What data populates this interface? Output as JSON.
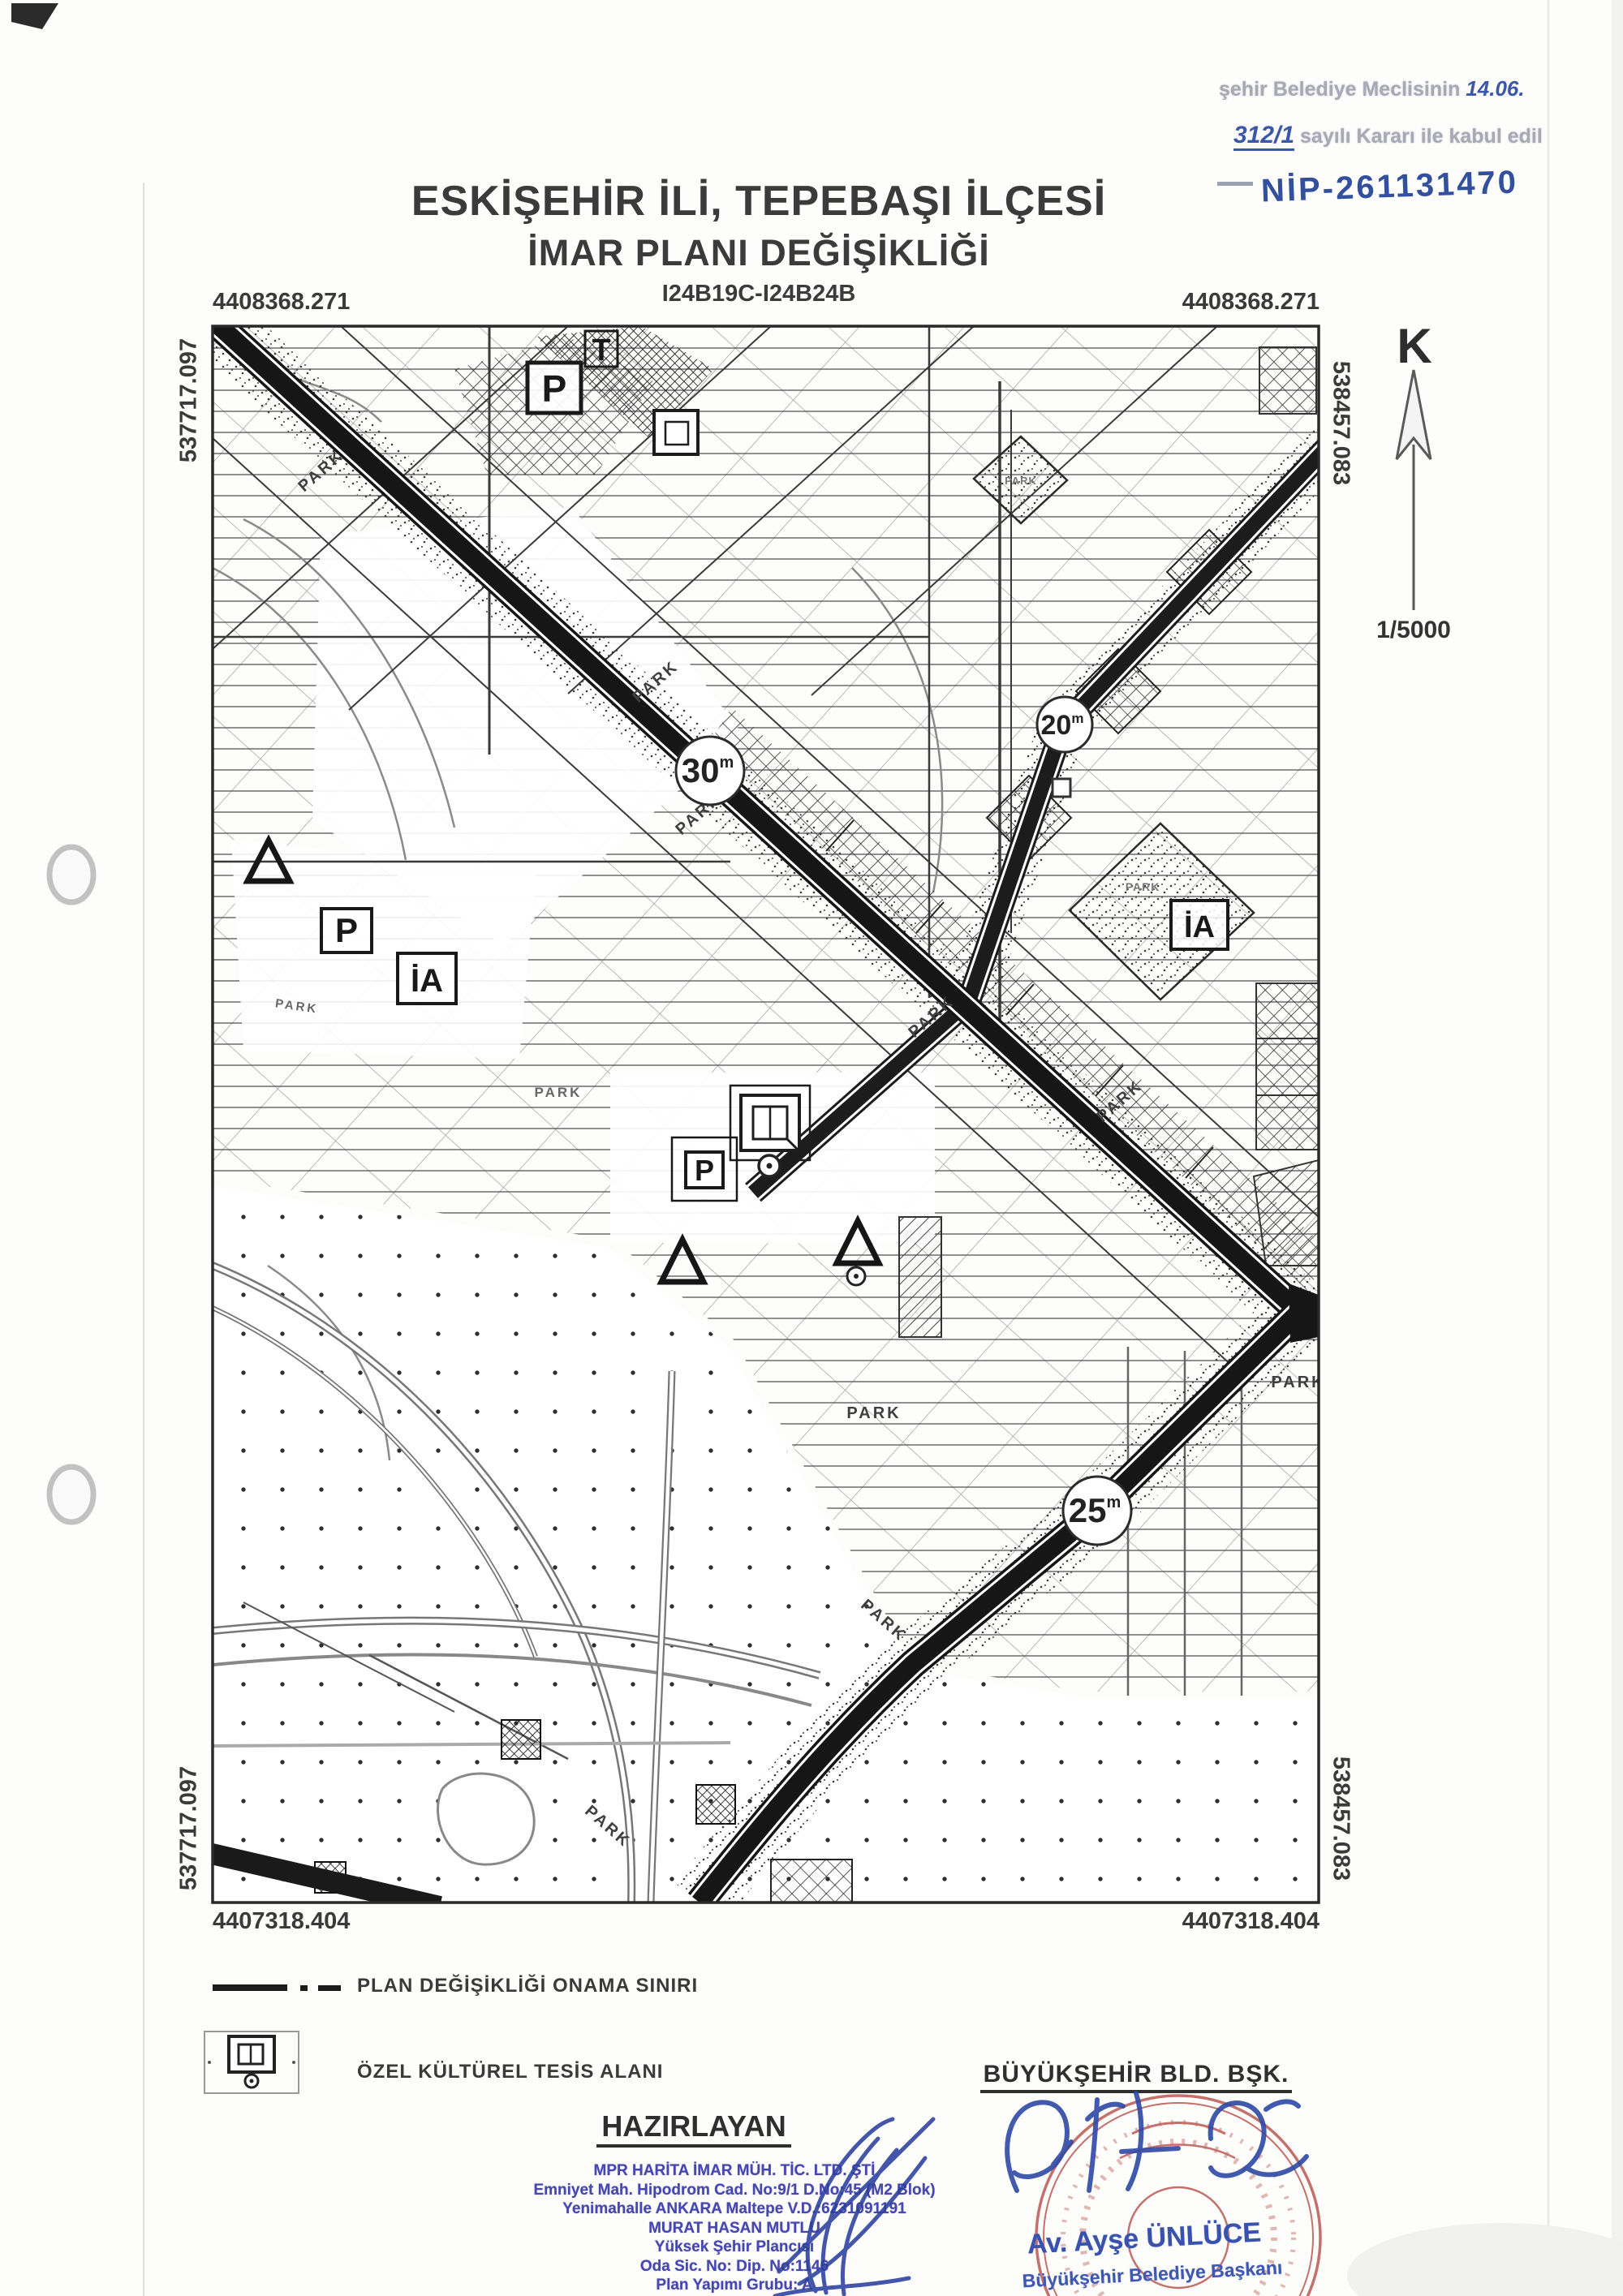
{
  "approval_note": {
    "stamp_text_1": "şehir Belediye Meclisinin",
    "handwritten_date": "14.06.",
    "handwritten_number": "312/1",
    "stamp_text_2": "sayılı Kararı ile kabul edil",
    "handwritten_nip": "NİP-261131470"
  },
  "title": {
    "line1": "ESKİŞEHİR İLİ, TEPEBAŞI İLÇESİ",
    "line2": "İMAR PLANI DEĞİŞİKLİĞİ",
    "sheet_code": "I24B19C-I24B24B"
  },
  "north_indicator": {
    "letter": "K",
    "scale": "1/5000"
  },
  "coordinates": {
    "north": "4408368.271",
    "south": "4407318.404",
    "west": "537717.097",
    "east": "538457.083"
  },
  "map": {
    "park_label": "PARK",
    "parking_label": "P",
    "trafo_label": "T",
    "ia_label": "İA",
    "badges": {
      "b30": {
        "value": "30",
        "unit": "m"
      },
      "b20": {
        "value": "20",
        "unit": "m"
      },
      "b25": {
        "value": "25",
        "unit": "m"
      }
    }
  },
  "legend": {
    "items": [
      {
        "label": "PLAN DEĞİŞİKLİĞİ ONAMA SINIRI"
      },
      {
        "label": "ÖZEL KÜLTÜREL TESİS ALANI"
      }
    ]
  },
  "prepared_by": {
    "heading": "HAZIRLAYAN",
    "lines": [
      "MPR HARİTA İMAR MÜH. TİC. LTD. ŞTİ",
      "Emniyet Mah. Hipodrom Cad. No:9/1 D.No:45 (M2 Blok)",
      "Yenimahalle ANKARA Maltepe V.D.:6231091191",
      "MURAT HASAN MUTLU",
      "Yüksek Şehir Plancısı",
      "Oda Sic. No:        Dip. No:1146",
      "Plan Yapımı Grubu: A"
    ]
  },
  "municipality": {
    "heading": "BÜYÜKŞEHİR BLD. BŞK.",
    "signer_name": "Av. Ayşe ÜNLÜCE",
    "signer_title": "Büyükşehir Belediye Başkanı"
  }
}
